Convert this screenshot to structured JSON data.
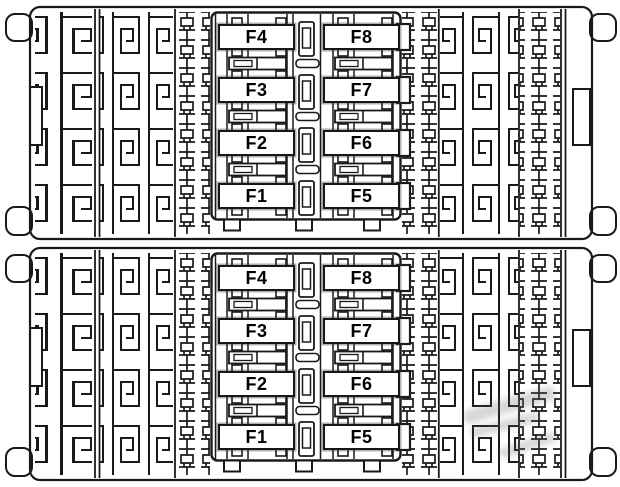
{
  "colors": {
    "background": "#ffffff",
    "trace_line": "#1a1a1a",
    "fuse_fill": "#ffffff",
    "fuse_border": "#161616",
    "label_color": "#000000"
  },
  "panels": [
    {
      "name": "upper fuse panel",
      "fuses": [
        "F4",
        "F8",
        "F3",
        "F7",
        "F2",
        "F6",
        "F1",
        "F5"
      ]
    },
    {
      "name": "lower fuse panel",
      "fuses": [
        "F4",
        "F8",
        "F3",
        "F7",
        "F2",
        "F6",
        "F1",
        "F5"
      ]
    }
  ]
}
